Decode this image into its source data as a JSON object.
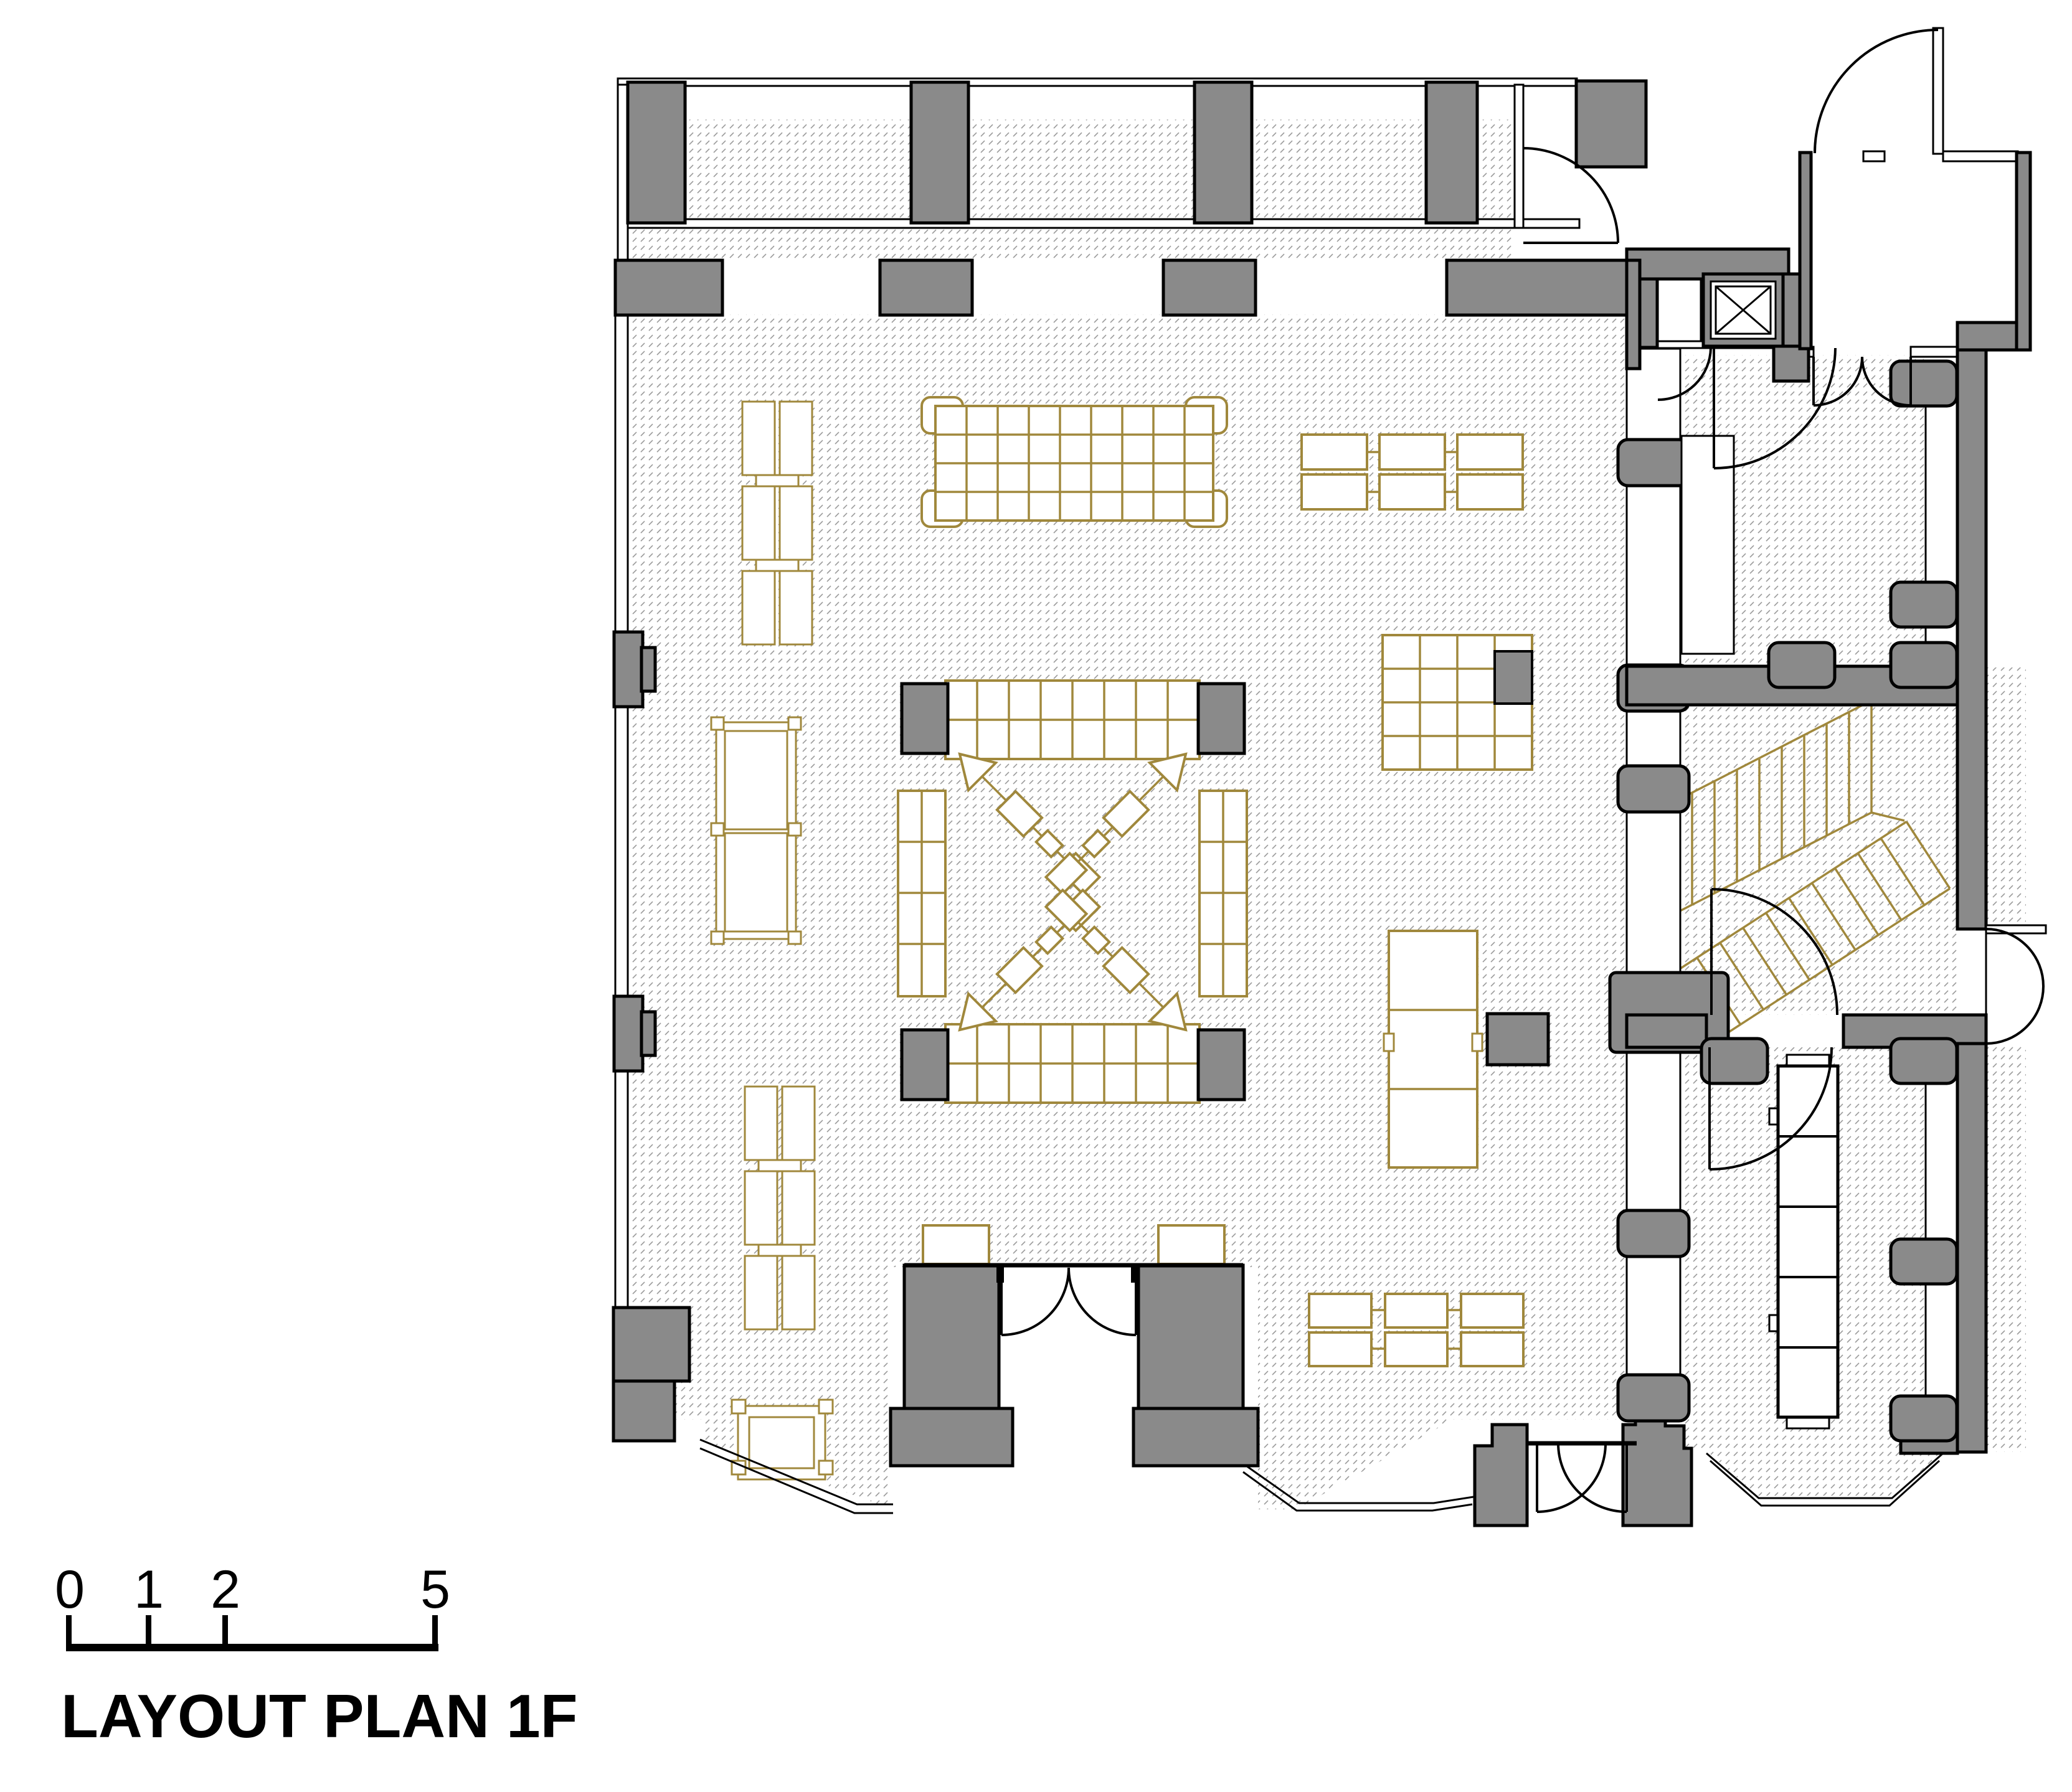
{
  "drawing": {
    "title": "LAYOUT PLAN 1F",
    "scale_bar": {
      "tick_labels": [
        "0",
        "1",
        "2",
        "5"
      ]
    },
    "colors": {
      "wall_fill": "#8a8a8a",
      "furniture_line": "#a0883c",
      "hatch_line": "#9c9c9c",
      "outline": "#000000",
      "paper": "#ffffff"
    }
  }
}
